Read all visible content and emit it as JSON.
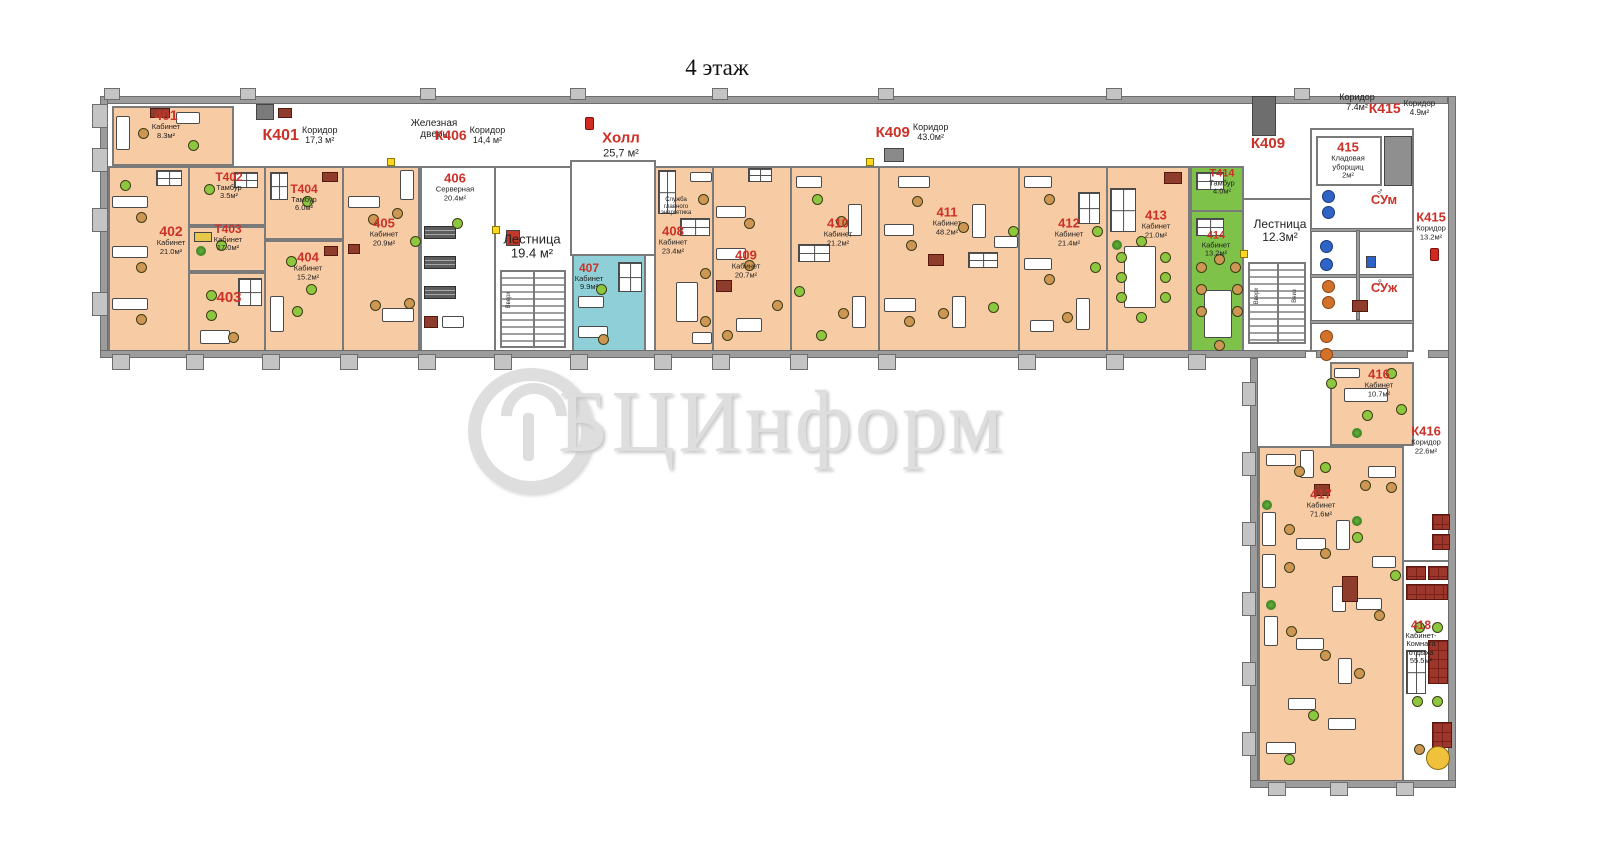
{
  "title": "4 этаж",
  "watermark": {
    "text": "БЦИнформ"
  },
  "colors": {
    "room_fill": "#f7cba3",
    "room_blue": "#8fd0d8",
    "room_green": "#7fc24a",
    "wall": "#9c9c9c",
    "label_accent": "#cc3128"
  },
  "rooms": [
    {
      "key": "401",
      "fill": "peach",
      "x": 112,
      "y": 106,
      "w": 122,
      "h": 60
    },
    {
      "key": "402",
      "fill": "peach",
      "x": 108,
      "y": 166,
      "w": 82,
      "h": 186
    },
    {
      "key": "t402",
      "fill": "peach",
      "x": 188,
      "y": 166,
      "w": 78,
      "h": 60
    },
    {
      "key": "t403",
      "fill": "peach",
      "x": 188,
      "y": 226,
      "w": 78,
      "h": 46
    },
    {
      "key": "403",
      "fill": "peach",
      "x": 188,
      "y": 272,
      "w": 78,
      "h": 80
    },
    {
      "key": "t404",
      "fill": "peach",
      "x": 264,
      "y": 166,
      "w": 80,
      "h": 74
    },
    {
      "key": "404",
      "fill": "peach",
      "x": 264,
      "y": 240,
      "w": 80,
      "h": 112
    },
    {
      "key": "405",
      "fill": "peach",
      "x": 342,
      "y": 166,
      "w": 78,
      "h": 186
    },
    {
      "key": "406",
      "fill": "white",
      "x": 420,
      "y": 166,
      "w": 76,
      "h": 186
    },
    {
      "key": "lest19",
      "fill": "white",
      "x": 494,
      "y": 166,
      "w": 80,
      "h": 186
    },
    {
      "key": "hall",
      "fill": "white",
      "x": 570,
      "y": 160,
      "w": 86,
      "h": 96
    },
    {
      "key": "407",
      "fill": "blue",
      "x": 572,
      "y": 254,
      "w": 74,
      "h": 98
    },
    {
      "key": "408",
      "fill": "peach",
      "x": 654,
      "y": 166,
      "w": 60,
      "h": 186
    },
    {
      "key": "409",
      "fill": "peach",
      "x": 712,
      "y": 166,
      "w": 80,
      "h": 186
    },
    {
      "key": "410",
      "fill": "peach",
      "x": 790,
      "y": 166,
      "w": 90,
      "h": 186
    },
    {
      "key": "411",
      "fill": "peach",
      "x": 878,
      "y": 166,
      "w": 142,
      "h": 186
    },
    {
      "key": "412",
      "fill": "peach",
      "x": 1018,
      "y": 166,
      "w": 90,
      "h": 186
    },
    {
      "key": "413",
      "fill": "peach",
      "x": 1106,
      "y": 166,
      "w": 84,
      "h": 186
    },
    {
      "key": "t414",
      "fill": "green",
      "x": 1190,
      "y": 166,
      "w": 54,
      "h": 46
    },
    {
      "key": "414",
      "fill": "green",
      "x": 1190,
      "y": 210,
      "w": 54,
      "h": 142
    },
    {
      "key": "lest12",
      "fill": "white",
      "x": 1242,
      "y": 198,
      "w": 70,
      "h": 154
    },
    {
      "key": "wc",
      "fill": "white",
      "x": 1310,
      "y": 128,
      "w": 104,
      "h": 224
    },
    {
      "key": "415",
      "fill": "white",
      "x": 1316,
      "y": 136,
      "w": 66,
      "h": 50
    },
    {
      "key": "416",
      "fill": "peach",
      "x": 1330,
      "y": 362,
      "w": 84,
      "h": 84
    },
    {
      "key": "417",
      "fill": "peach",
      "x": 1258,
      "y": 446,
      "w": 146,
      "h": 336
    },
    {
      "key": "418",
      "fill": "white",
      "x": 1402,
      "y": 560,
      "w": 48,
      "h": 222
    }
  ],
  "labels": [
    {
      "k": "room",
      "id": "401",
      "name": "Кабинет",
      "area": "8.3м²",
      "x": 166,
      "y": 124,
      "s": 14
    },
    {
      "k": "corr",
      "id": "К401",
      "name": "Коридор",
      "area": "17,3 м²",
      "x": 300,
      "y": 136,
      "s": 16
    },
    {
      "k": "text",
      "lines": [
        "Железная",
        "дверь"
      ],
      "x": 434,
      "y": 129,
      "fs": 10
    },
    {
      "k": "corr",
      "id": "К406",
      "name": "Коридор",
      "area": "14,4 м²",
      "x": 470,
      "y": 136,
      "s": 14
    },
    {
      "k": "room",
      "id": "Холл",
      "area": "25,7 м²",
      "x": 621,
      "y": 145,
      "s": 15,
      "as": 11
    },
    {
      "k": "corr",
      "id": "К409",
      "name": "Коридор",
      "area": "43.0м²",
      "x": 912,
      "y": 133,
      "s": 15
    },
    {
      "k": "text",
      "lines": [
        "Коридор",
        "7.4м²"
      ],
      "x": 1357,
      "y": 103,
      "fs": 9
    },
    {
      "k": "corr",
      "id": "К415",
      "name": "Коридор",
      "area": "4.9м²",
      "x": 1402,
      "y": 109,
      "s": 14,
      "ss": 8
    },
    {
      "k": "red",
      "t": "К409",
      "x": 1268,
      "y": 144,
      "s": 15
    },
    {
      "k": "room",
      "id": "402",
      "name": "Кабинет",
      "area": "21.0м²",
      "x": 171,
      "y": 240,
      "s": 14
    },
    {
      "k": "room",
      "id": "Т402",
      "name": "Тамбур",
      "area": "3.5м²",
      "x": 229,
      "y": 186,
      "s": 12
    },
    {
      "k": "room",
      "id": "Т403",
      "name": "Кабинет",
      "area": "17.0м²",
      "x": 228,
      "y": 238,
      "s": 12
    },
    {
      "k": "red",
      "t": "403",
      "x": 229,
      "y": 298,
      "s": 15
    },
    {
      "k": "room",
      "id": "Т404",
      "name": "Тамбур",
      "area": "6.0м²",
      "x": 304,
      "y": 198,
      "s": 12
    },
    {
      "k": "room",
      "id": "404",
      "name": "Кабинет",
      "area": "15.2м²",
      "x": 308,
      "y": 266,
      "s": 13
    },
    {
      "k": "room",
      "id": "405",
      "name": "Кабинет",
      "area": "20.9м²",
      "x": 384,
      "y": 232,
      "s": 13
    },
    {
      "k": "room",
      "id": "406",
      "name": "Серверная",
      "area": "20.4м²",
      "x": 455,
      "y": 187,
      "s": 13
    },
    {
      "k": "text",
      "lines": [
        "Лестница",
        "19.4 м²"
      ],
      "x": 532,
      "y": 247,
      "fs": 13
    },
    {
      "k": "room",
      "id": "407",
      "name": "Кабинет",
      "area": "9.9м²",
      "x": 589,
      "y": 277,
      "s": 12
    },
    {
      "k": "text",
      "lines": [
        "Служба",
        "главного",
        "энергетика"
      ],
      "x": 676,
      "y": 207,
      "fs": 6
    },
    {
      "k": "room",
      "id": "408",
      "name": "Кабинет",
      "area": "23.4м²",
      "x": 673,
      "y": 240,
      "s": 13
    },
    {
      "k": "room",
      "id": "409",
      "name": "Кабинет",
      "area": "20.7м²",
      "x": 746,
      "y": 264,
      "s": 13
    },
    {
      "k": "room",
      "id": "410",
      "name": "Кабинет",
      "area": "21.2м²",
      "x": 838,
      "y": 232,
      "s": 13
    },
    {
      "k": "room",
      "id": "411",
      "name": "Кабинет",
      "area": "48.2м²",
      "x": 947,
      "y": 221,
      "s": 13
    },
    {
      "k": "room",
      "id": "412",
      "name": "Кабинет",
      "area": "21.4м²",
      "x": 1069,
      "y": 232,
      "s": 13
    },
    {
      "k": "room",
      "id": "413",
      "name": "Кабинет",
      "area": "21.0м²",
      "x": 1156,
      "y": 224,
      "s": 13
    },
    {
      "k": "room",
      "id": "Т414",
      "name": "Тамбур",
      "area": "4.0м²",
      "x": 1222,
      "y": 182,
      "s": 11
    },
    {
      "k": "room",
      "id": "414",
      "name": "Кабинет",
      "area": "13.2м²",
      "x": 1216,
      "y": 244,
      "s": 11
    },
    {
      "k": "text",
      "lines": [
        "Лестница",
        "12.3м²"
      ],
      "x": 1280,
      "y": 231,
      "fs": 12
    },
    {
      "k": "room",
      "id": "415",
      "name_lines": [
        "Кладовая",
        "уборщиц"
      ],
      "area": "2м²",
      "x": 1348,
      "y": 160,
      "s": 13
    },
    {
      "k": "red",
      "t": "СУм",
      "x": 1384,
      "y": 200,
      "s": 13
    },
    {
      "k": "red",
      "t": "СУж",
      "x": 1384,
      "y": 288,
      "s": 13
    },
    {
      "k": "room",
      "id": "К415",
      "name": "Коридор",
      "area": "13.2м²",
      "x": 1431,
      "y": 226,
      "s": 13
    },
    {
      "k": "room",
      "id": "416",
      "name": "Кабинет",
      "area": "10.7м²",
      "x": 1379,
      "y": 383,
      "s": 13
    },
    {
      "k": "room",
      "id": "К416",
      "name": "Коридор",
      "area": "22.6м²",
      "x": 1426,
      "y": 440,
      "s": 13
    },
    {
      "k": "room",
      "id": "417",
      "name": "Кабинет",
      "area": "71.6м²",
      "x": 1321,
      "y": 503,
      "s": 13
    },
    {
      "k": "room",
      "id": "418",
      "name_lines": [
        "Кабинет-",
        "Комната",
        "отдыха"
      ],
      "area": "55.5м²",
      "x": 1421,
      "y": 642,
      "s": 12
    },
    {
      "k": "vtext",
      "t": "Вверх",
      "x": 509,
      "y": 300
    },
    {
      "k": "vtext",
      "t": "Вверх",
      "x": 1257,
      "y": 296
    },
    {
      "k": "vtext",
      "t": "Вниз",
      "x": 1295,
      "y": 296
    }
  ]
}
